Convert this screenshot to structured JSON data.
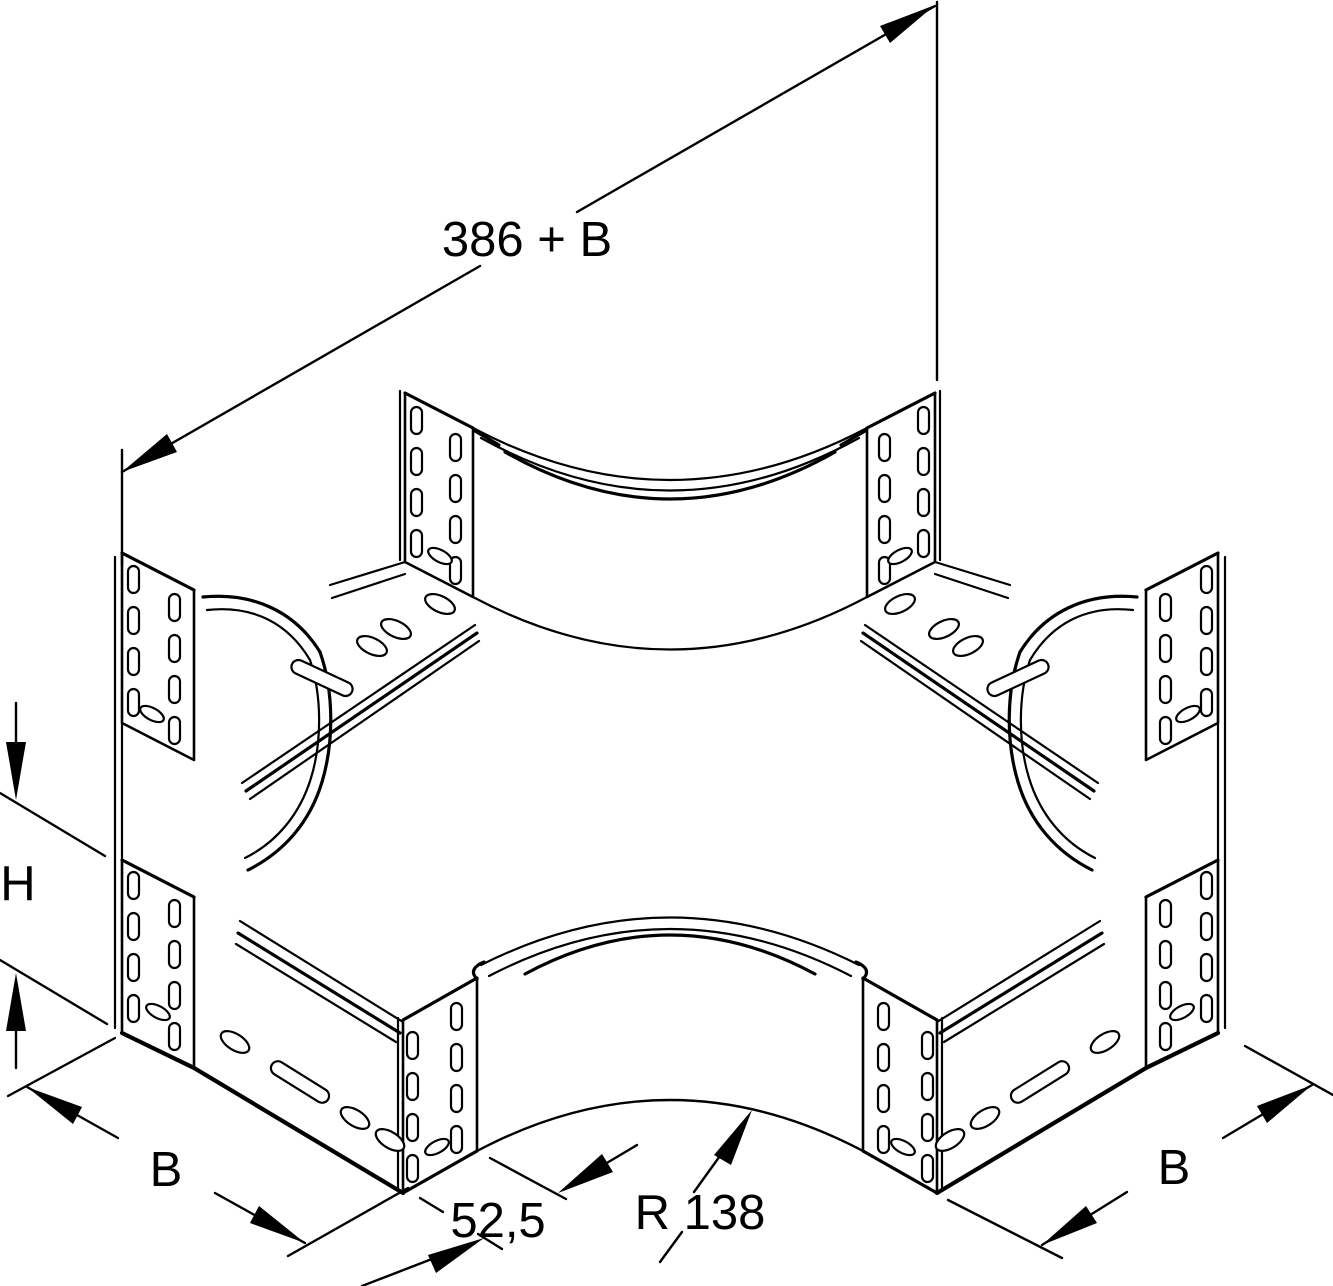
{
  "drawing": {
    "background_color": "#ffffff",
    "line_color": "#000000",
    "labels": {
      "total_length": "386 + B",
      "side_height": "H",
      "width_left": "B",
      "width_right": "B",
      "corner_offset": "52,5",
      "corner_radius": "R 138"
    }
  }
}
